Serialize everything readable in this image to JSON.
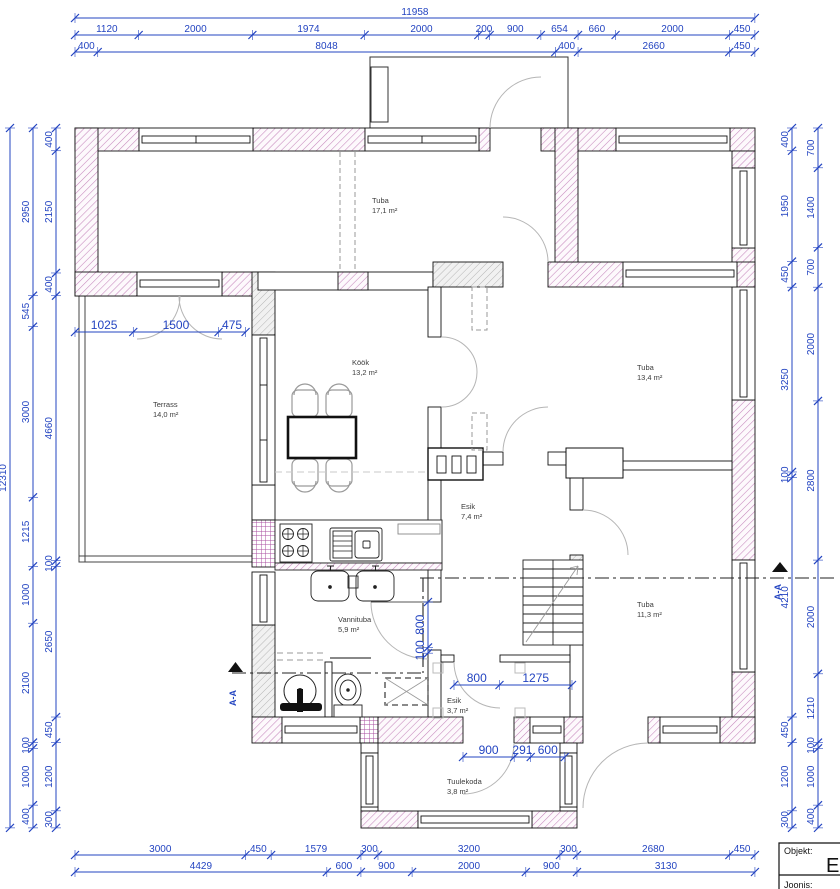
{
  "rooms": [
    {
      "name": "Tuba",
      "area": "17,1 m²"
    },
    {
      "name": "Köök",
      "area": "13,2 m²"
    },
    {
      "name": "Tuba",
      "area": "13,4 m²"
    },
    {
      "name": "Terrass",
      "area": "14,0 m²"
    },
    {
      "name": "Esik",
      "area": "7,4 m²"
    },
    {
      "name": "Tuba",
      "area": "11,3 m²"
    },
    {
      "name": "Vannituba",
      "area": "5,9 m²"
    },
    {
      "name": "Esik",
      "area": "3,7 m²"
    },
    {
      "name": "Tuulekoda",
      "area": "3,8 m²"
    }
  ],
  "dims": {
    "top_total": [
      11958
    ],
    "top_row2": [
      1120,
      2000,
      1974,
      2000,
      200,
      900,
      654,
      660,
      2000,
      450
    ],
    "top_row3": [
      400,
      8048,
      400,
      2660,
      450
    ],
    "bottom_row1": [
      3000,
      450,
      1579,
      300,
      3200,
      300,
      2680,
      450
    ],
    "bottom_row2": [
      4429,
      600,
      900,
      2000,
      900,
      3130
    ],
    "left_total": [
      12310
    ],
    "left_mid": [
      2950,
      545,
      3000,
      1215,
      1000,
      2100,
      100,
      1000,
      400
    ],
    "left_inner": [
      400,
      2150,
      400,
      4660,
      100,
      2650,
      450,
      1200,
      300
    ],
    "right_inner": [
      400,
      1950,
      450,
      3250,
      100,
      4210,
      450,
      1200,
      300
    ],
    "right_outer": [
      700,
      1400,
      700,
      2000,
      2800,
      2000,
      1210,
      100,
      1000,
      400
    ],
    "terrace_door": [
      1025,
      1500,
      475
    ],
    "bath_door": [
      800,
      100
    ],
    "esik3_door": [
      800,
      1275
    ],
    "tuulekoda_door": [
      900,
      291,
      600
    ]
  },
  "section": {
    "label": "A-A"
  },
  "title_block": {
    "objekt_label": "Objekt:",
    "objekt_value": "E",
    "joonis_label": "Joonis:"
  },
  "colors": {
    "dimension": "#2344c1",
    "wall": "#111111",
    "hatch_pink": "#c687bd",
    "hatch_tile": "#aa4fa0",
    "arc": "#b5b5b5"
  }
}
